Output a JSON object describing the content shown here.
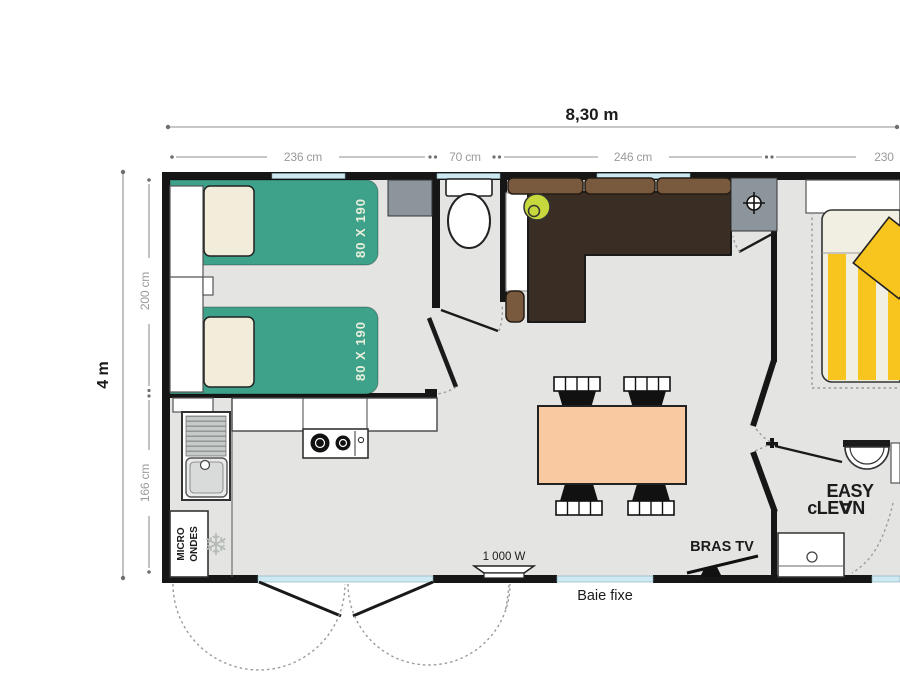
{
  "dimensions": {
    "total_width_label": "8,30 m",
    "total_height_label": "4 m",
    "top_segments": [
      "236 cm",
      "70 cm",
      "246 cm",
      "230"
    ],
    "left_segments": [
      "200 cm",
      "166 cm"
    ]
  },
  "rooms": {
    "twin_bedroom": {
      "bed1_size": "80 X 190",
      "bed2_size": "80 X 190"
    },
    "kitchen": {
      "microwave_line1": "MICRO",
      "microwave_line2": "ONDES"
    },
    "bathroom": {
      "logo_line1": "EASY",
      "logo_line2": "cLE∀N"
    }
  },
  "annotations": {
    "heater_power": "1 000 W",
    "tv_bracket": "BRAS TV",
    "fixed_window": "Baie fixe"
  },
  "icons": {
    "freezer_snowflake": "❄"
  },
  "colors": {
    "wall": "#161616",
    "floor": "#e4e5e3",
    "window_blue": "#cfe9f2",
    "bed_green": "#3ea189",
    "pillow_cream": "#f1edda",
    "bed_label": "#e9efdc",
    "cabinet_gray": "#8d959c",
    "sofa_dark": "#3a2d24",
    "sofa_cushion": "#7a5a3e",
    "lamp_green": "#c6d83c",
    "bed_yellow": "#f8c41e",
    "bed_cream": "#f1eee2",
    "table_peach": "#f9c9a2"
  }
}
